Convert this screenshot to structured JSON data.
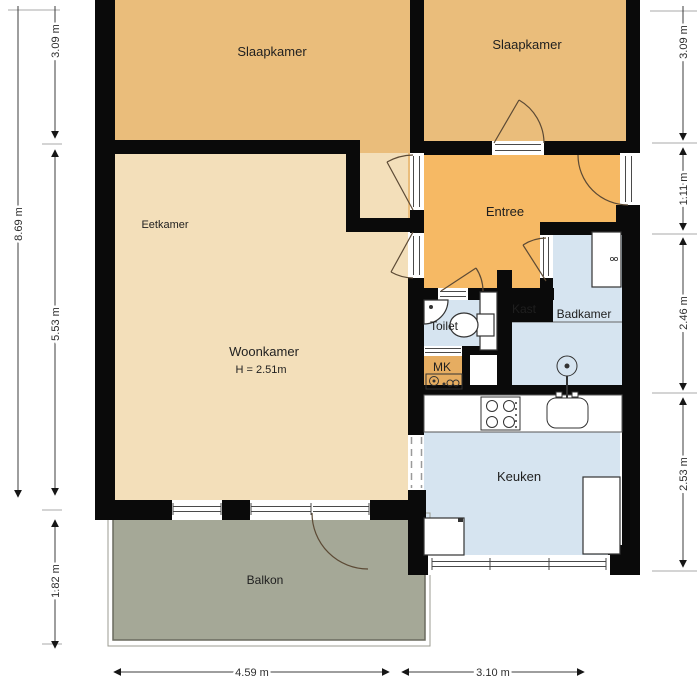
{
  "plan": {
    "type": "apartment-floor-plan",
    "rooms": {
      "slaapkamer_left": {
        "label": "Slaapkamer"
      },
      "slaapkamer_right": {
        "label": "Slaapkamer"
      },
      "eetkamer": {
        "label": "Eetkamer"
      },
      "woonkamer": {
        "label": "Woonkamer",
        "height_note": "H = 2.51m"
      },
      "entree": {
        "label": "Entree"
      },
      "kast": {
        "label": "Kast"
      },
      "toilet": {
        "label": "Toilet"
      },
      "badkamer": {
        "label": "Badkamer"
      },
      "mk": {
        "label": "MK"
      },
      "keuken": {
        "label": "Keuken"
      },
      "balkon": {
        "label": "Balkon"
      }
    },
    "dimensions": {
      "left_overall": "8.69 m",
      "left_upper": "3.09 m",
      "left_lower": "5.53 m",
      "left_balcony": "1.82 m",
      "right_bedroom": "3.09 m",
      "right_entrance": "1.11 m",
      "right_bathroom": "2.46 m",
      "right_kitchen": "2.53 m",
      "bottom_living": "4.59 m",
      "bottom_kitchen": "3.10 m"
    },
    "colors": {
      "wall": "#0a0a0a",
      "bedroom": "#eabd7b",
      "living": "#f3dfba",
      "entree": "#f6b964",
      "closet": "#e6ad61",
      "wet": "#d6e4f0",
      "balcony": "#a5a897"
    }
  }
}
